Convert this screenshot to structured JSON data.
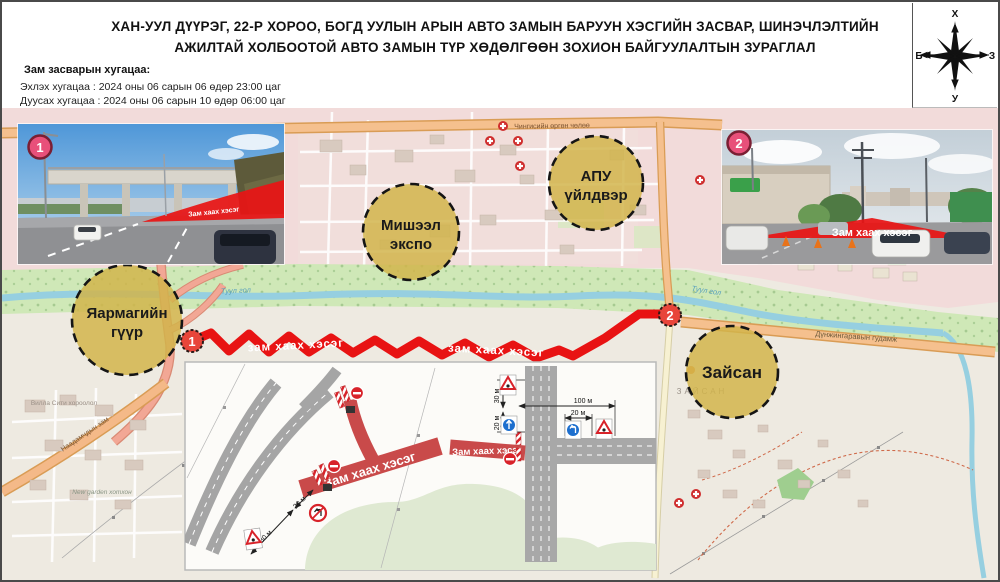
{
  "header": {
    "title_line1": "ХАН-УУЛ ДҮҮРЭГ, 22-Р ХОРОО, БОГД УУЛЫН АРЫН АВТО ЗАМЫН БАРУУН ХЭСГИЙН ЗАСВАР, ШИНЭЧЛЭЛТИЙН",
    "title_line2": "АЖИЛТАЙ ХОЛБООТОЙ АВТО ЗАМЫН ТҮР ХӨДӨЛГӨӨН ЗОХИОН БАЙГУУЛАЛТЫН ЗУРАГЛАЛ",
    "schedule_heading": "Зам засварын хугацаа:",
    "schedule_start": "Эхлэх хугацаа : 2024 оны 06 сарын 06 өдөр 23:00 цаг",
    "schedule_end": "Дуусах хугацаа : 2024 оны 06 сарын 10 өдөр 06:00 цаг"
  },
  "compass": {
    "north": "Х",
    "south": "У",
    "east": "З",
    "west": "Б"
  },
  "map": {
    "closure_label": "зам хаах хэсэг",
    "river_label": "Туул гол",
    "roads": {
      "chinggis": "Чингисийн өргөн чөлөө",
      "dunjingarav": "Дүнжингаравын гудамж",
      "naadamchdyn": "Наадамчдын зам",
      "zaisan_street": "Zaisan Street"
    },
    "districts": {
      "villa_city": "Вилла Сити хороолол",
      "new_garden": "New garden хотхон",
      "zaisan": "ЗАЙСАН"
    },
    "landmarks": [
      {
        "label": "Яармагийн гүүр",
        "line1": "Яармагийн",
        "line2": "гүүр"
      },
      {
        "label": "Мишээл экспо",
        "line1": "Мишээл",
        "line2": "экспо"
      },
      {
        "label": "АПУ үйлдвэр",
        "line1": "АПУ",
        "line2": "үйлдвэр"
      },
      {
        "label": "Зайсан",
        "line1": "Зайсан",
        "line2": ""
      }
    ],
    "markers": [
      {
        "number": "1"
      },
      {
        "number": "2"
      }
    ]
  },
  "photos": [
    {
      "marker": "1",
      "overlay_label": "Зам хаах хэсэг"
    },
    {
      "marker": "2",
      "overlay_label": "Зам хаах хэсэг"
    }
  ],
  "inset": {
    "closure_label_main": "Зам хаах хэсэг",
    "closure_label_secondary": "Зам хаах хэсэг",
    "dim_30": "30 м",
    "dim_20": "20 м",
    "dim_100": "100 м"
  },
  "colors": {
    "closure_red": "#e81313",
    "inset_red": "#c94a4a",
    "landmark_yellow": "#d2b44a",
    "marker_red": "#e8453a",
    "road_orange": "#f5c08e",
    "road_salmon": "#f2a795",
    "river_blue": "#96cfe0",
    "green_corridor": "#cfe8b7",
    "urban_pink": "#f2dbda"
  }
}
